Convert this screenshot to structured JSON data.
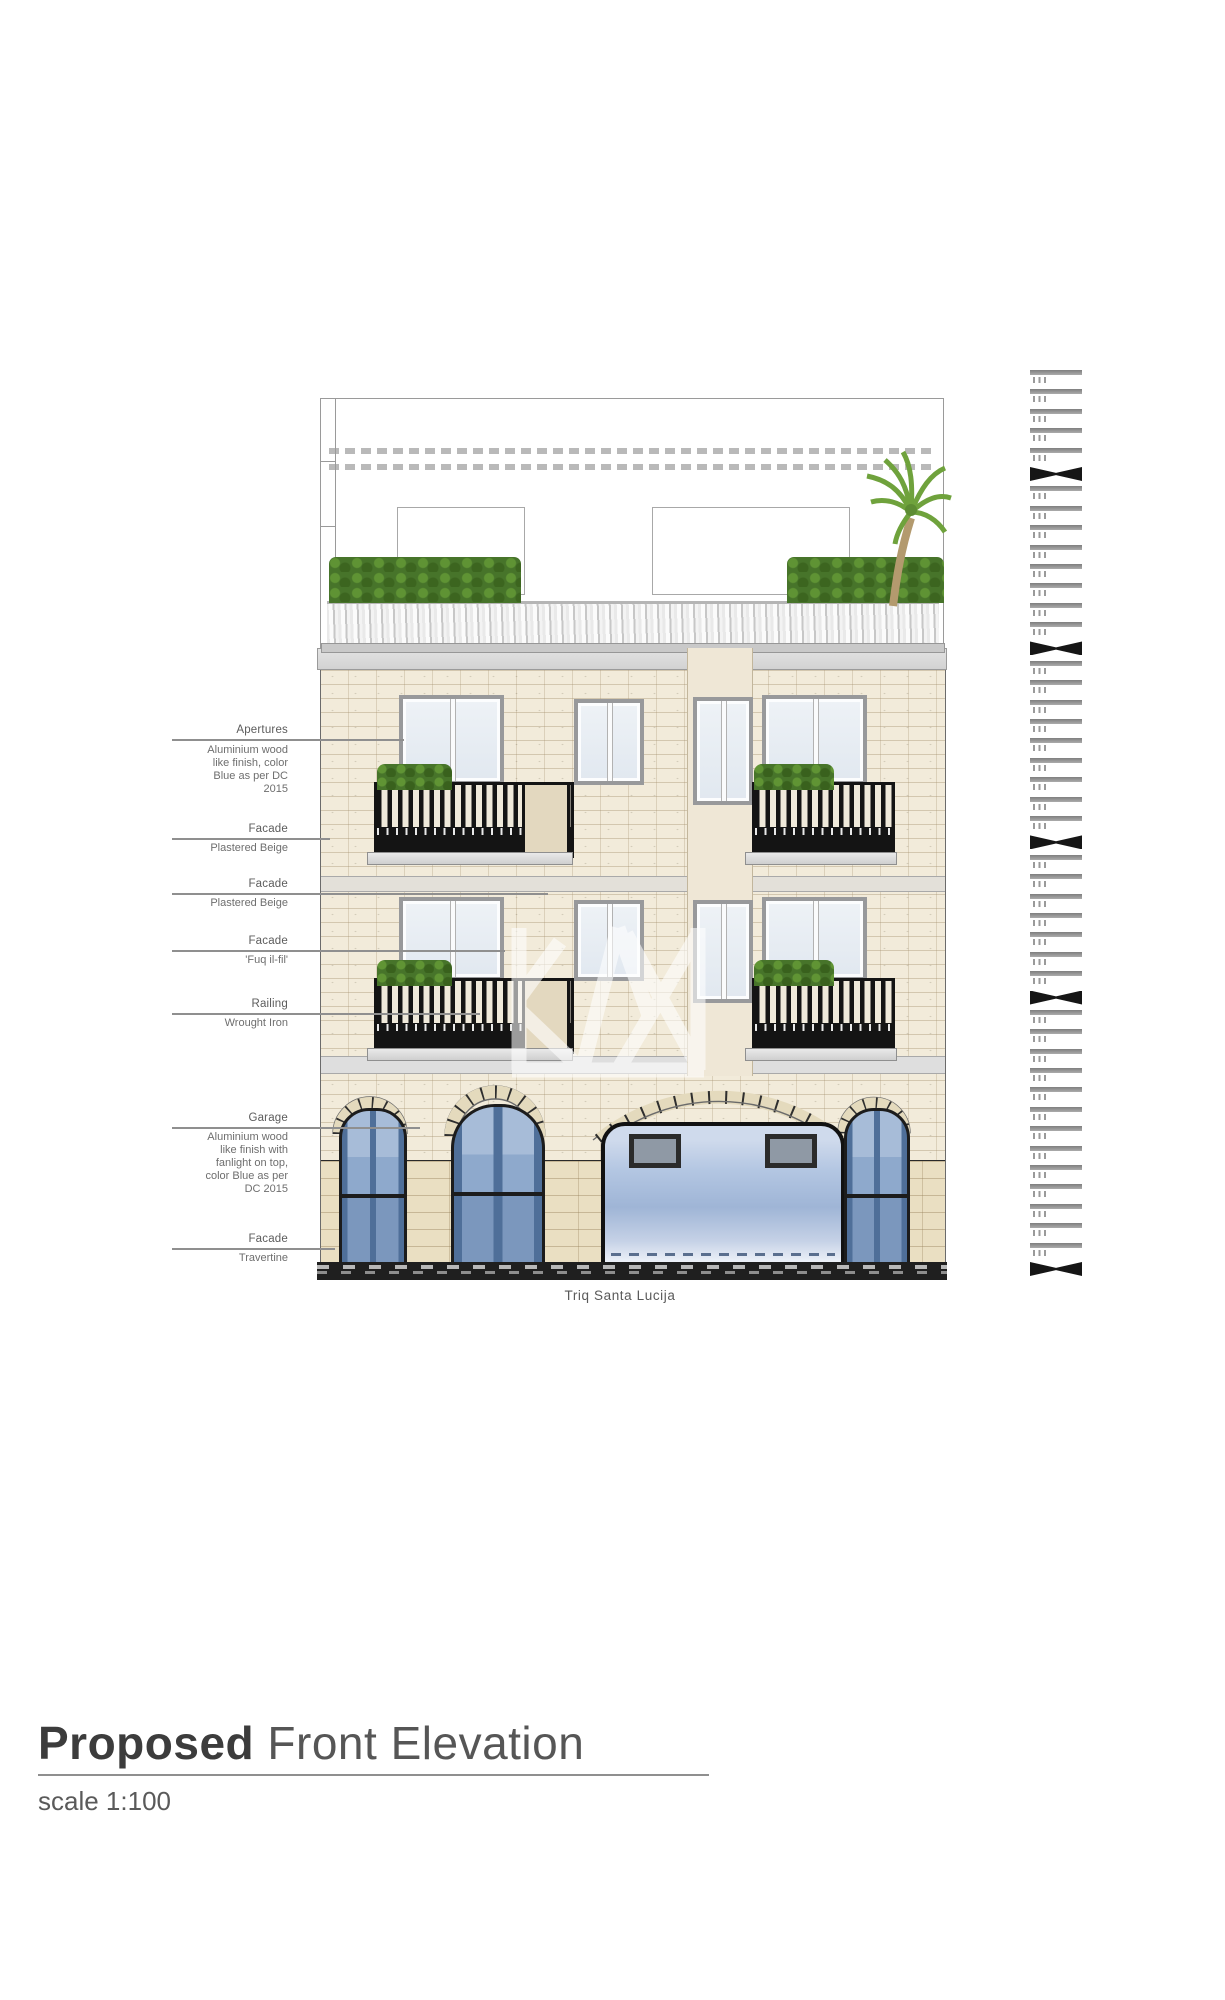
{
  "document": {
    "kind": "architectural-elevation-sheet",
    "street_label": "Triq Santa Lucija",
    "title": {
      "emphasis": "Proposed",
      "rest": " Front Elevation",
      "scale": "scale 1:100"
    }
  },
  "annotations": {
    "items": [
      {
        "title": "Apertures",
        "body": "Aluminium wood\nlike finish, color\nBlue as per DC\n2015"
      },
      {
        "title": "Facade",
        "body": "Plastered Beige"
      },
      {
        "title": "Facade",
        "body": "Plastered Beige"
      },
      {
        "title": "Facade",
        "body": "'Fuq il-fil'"
      },
      {
        "title": "Railing",
        "body": "Wrought Iron"
      },
      {
        "title": "Garage",
        "body": "Aluminium wood\nlike finish with\nfanlight on top,\ncolor Blue as per\nDC 2015"
      },
      {
        "title": "Facade",
        "body": "Travertine"
      }
    ]
  },
  "party_wall": {
    "rows": [
      "b",
      "b",
      "b",
      "b",
      "b",
      "x",
      "b",
      "b",
      "b",
      "b",
      "b",
      "b",
      "b",
      "b",
      "x",
      "b",
      "b",
      "b",
      "b",
      "b",
      "b",
      "b",
      "b",
      "b",
      "x",
      "b",
      "b",
      "b",
      "b",
      "b",
      "b",
      "b",
      "x",
      "b",
      "b",
      "b",
      "b",
      "b",
      "b",
      "b",
      "b",
      "b",
      "b",
      "b",
      "b",
      "b",
      "x"
    ]
  },
  "palette": {
    "facade_stone": "#f2ebda",
    "stone_joint": "#cbbfa4",
    "cornice_gray": "#d8d8d8",
    "railing_black": "#141414",
    "plant_green": "#4e7d2a",
    "palm_green": "#6fa23c",
    "door_blue": "#54749e",
    "door_panel_blue": "#9db4d4",
    "garage_blue": "#b3c6e2",
    "travertine": "#eadfc2",
    "base_dark": "#1f1f1f",
    "annotation_gray": "#6e6e6e",
    "watermark_white": "#ffffff"
  }
}
